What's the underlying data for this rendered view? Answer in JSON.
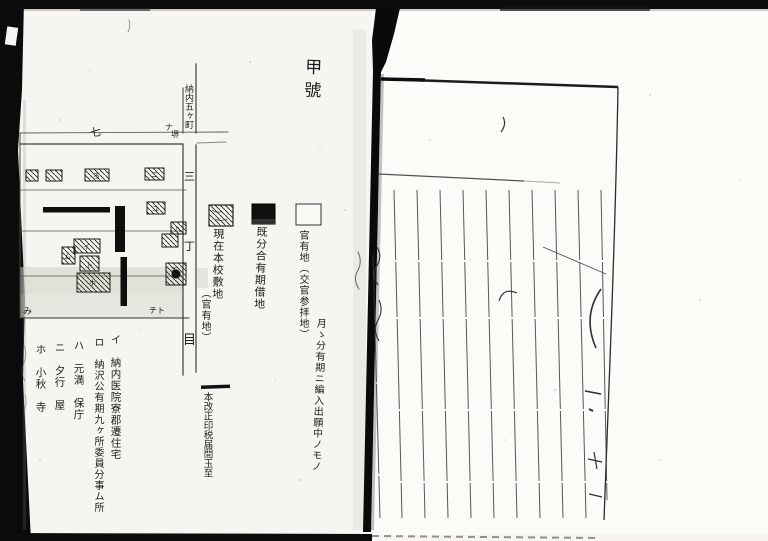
{
  "page": {
    "label": "甲號",
    "map": {
      "street_top_label": "納内五ヶ町",
      "street_chars": [
        "三",
        "丁",
        "目"
      ],
      "mark_seven": "七",
      "mark_crossing_a": "ナ",
      "mark_crossing_b": "堺",
      "mark_bottom_left": "み",
      "mark_bottom_right": "チト",
      "buildings": {
        "b3": "ろ",
        "b4": "ニ",
        "b5": "ユ",
        "bA": "イ",
        "bB": "ム",
        "bC": "卜",
        "bD": "ホ",
        "bE": "ハ",
        "bF": "キ"
      }
    },
    "legend": {
      "items": [
        {
          "swatch": "hatched",
          "label": "現在本校敷地",
          "sublabel": "（官有地）"
        },
        {
          "swatch": "black",
          "label": "既分合有期借地"
        },
        {
          "swatch": "white",
          "label": "官有地（交官参拝地）",
          "label2": "月ゝ分有期ニ編入出願中ノモノ"
        }
      ]
    },
    "notes": [
      "イ　納内医院寮郡遷住宅",
      "ロ　納沢公有期九ヶ所委員分事ム所",
      "ハ　元満　保庁",
      "ニ　夕行　屋",
      "ホ　小秋　寺"
    ],
    "footnote": "本改正印税届間玉至"
  }
}
